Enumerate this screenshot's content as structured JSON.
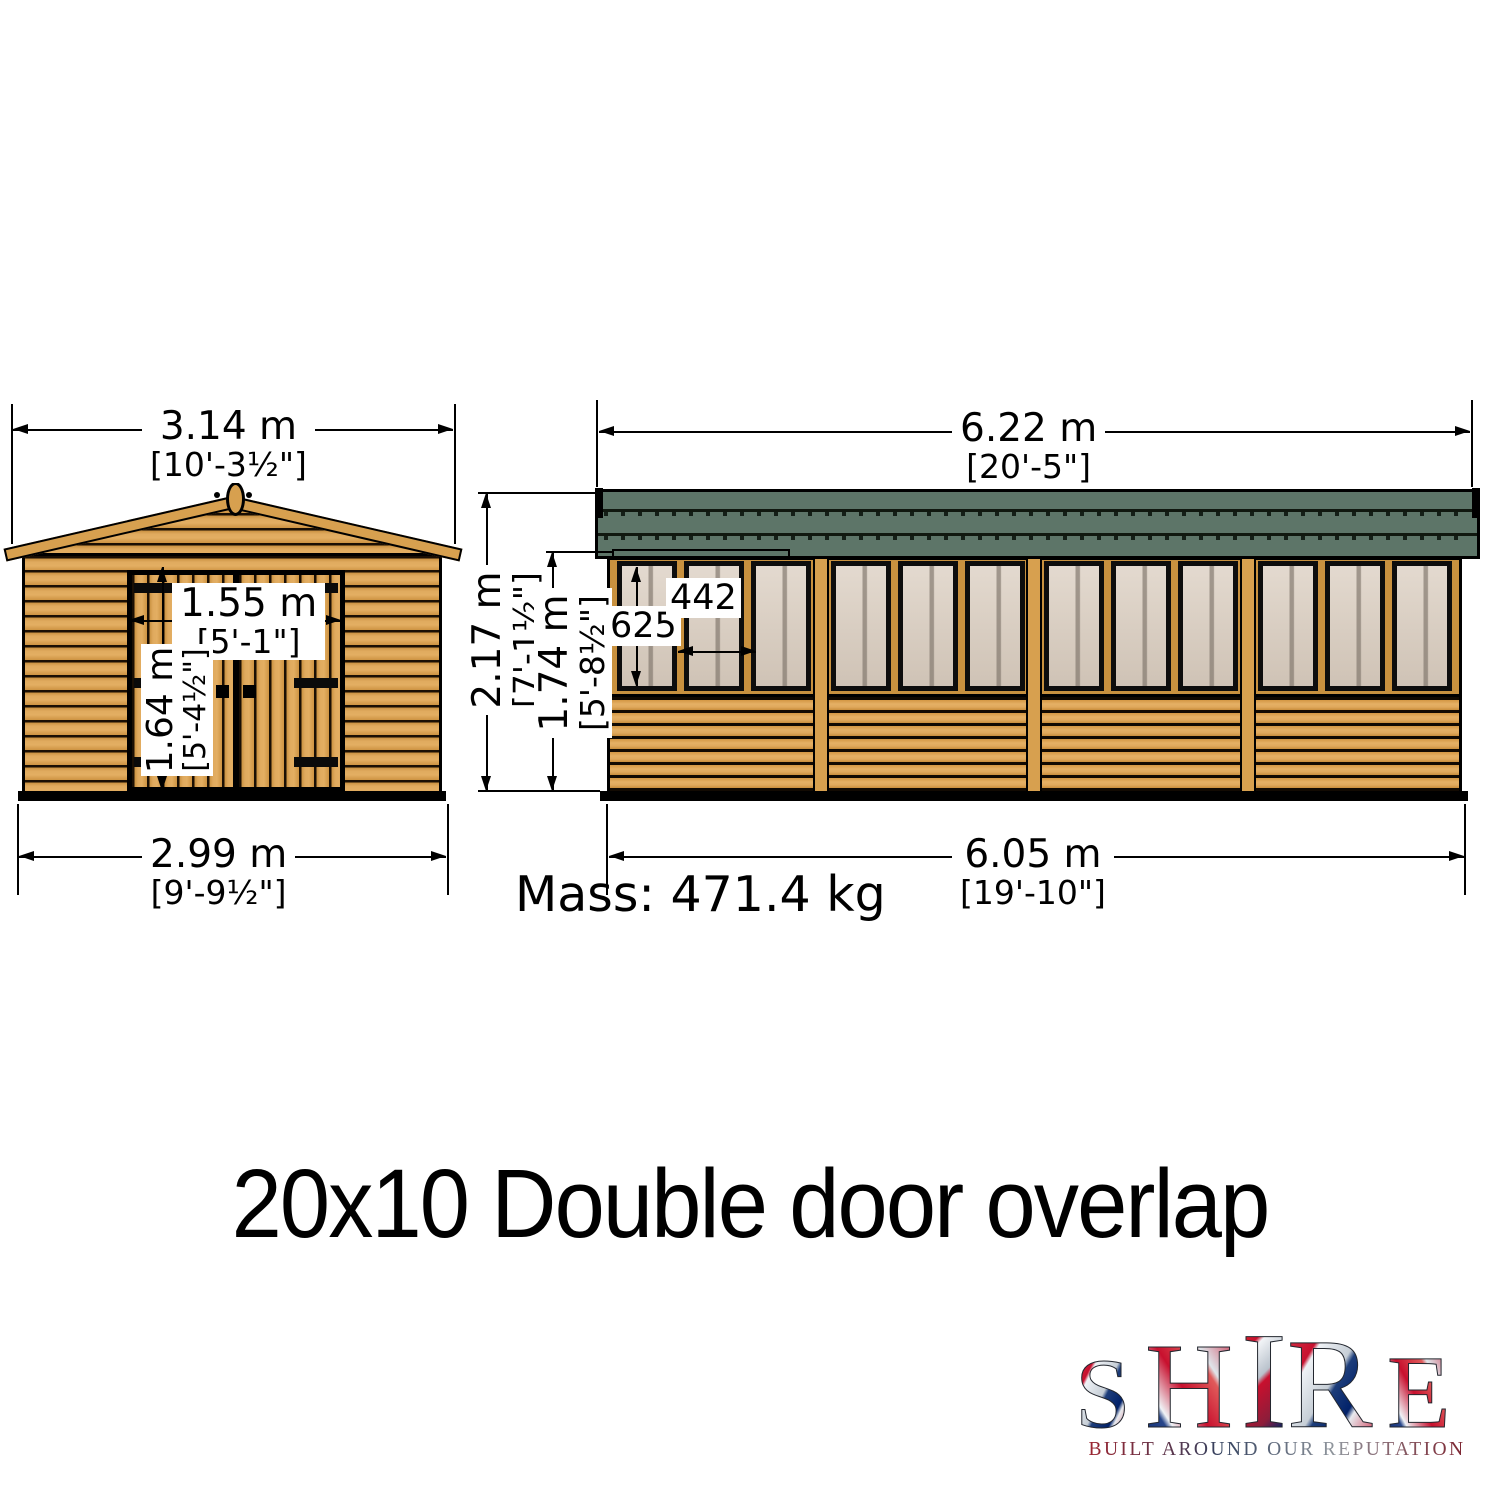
{
  "front_view": {
    "overall_width": {
      "metric": "3.14 m",
      "imperial": "[10'-3½\"]"
    },
    "door_width": {
      "metric": "1.55 m",
      "imperial": "[5'-1\"]"
    },
    "door_height": {
      "metric": "1.64 m",
      "imperial": "[5'-4½\"]"
    },
    "base_width": {
      "metric": "2.99 m",
      "imperial": "[9'-9½\"]"
    }
  },
  "side_view": {
    "overall_length": {
      "metric": "6.22 m",
      "imperial": "[20'-5\"]"
    },
    "overall_height": {
      "metric": "2.17 m",
      "imperial": "[7'-1½\"]"
    },
    "eaves_height": {
      "metric": "1.74 m",
      "imperial": "[5'-8½\"]"
    },
    "base_length": {
      "metric": "6.05 m",
      "imperial": "[19'-10\"]"
    },
    "window_height_mm": "625",
    "window_width_mm": "442"
  },
  "mass_label": "Mass: 471.4 kg",
  "title": "20x10 Double door overlap",
  "logo": {
    "letters": [
      "S",
      "H",
      "I",
      "R",
      "E"
    ],
    "tagline": "BUILT AROUND OUR REPUTATION"
  },
  "colors": {
    "wood": "#d7a04f",
    "roof_green": "#5d7568",
    "glass": "#dacdbf",
    "outline": "#000000"
  }
}
